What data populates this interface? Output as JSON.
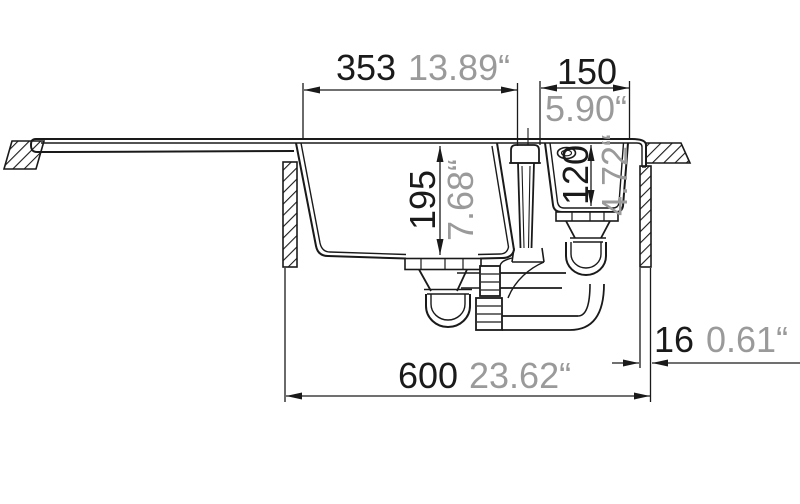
{
  "drawing": {
    "kind": "sink cross-section technical drawing",
    "dimensions": {
      "main_bowl_width": {
        "mm": "353",
        "inch": "13.89“"
      },
      "small_bowl_width": {
        "mm": "150",
        "inch": "5.90“"
      },
      "main_bowl_depth": {
        "mm": "195",
        "inch": "7.68“"
      },
      "small_bowl_depth": {
        "mm": "120",
        "inch": "4.72“"
      },
      "edge_distance": {
        "mm": "16",
        "inch": "0.61“"
      },
      "cabinet_width": {
        "mm": "600",
        "inch": "23.62“"
      }
    },
    "colors": {
      "line": "#1a1a1a",
      "inch_text": "#9a9a9a",
      "background": "#ffffff"
    }
  }
}
